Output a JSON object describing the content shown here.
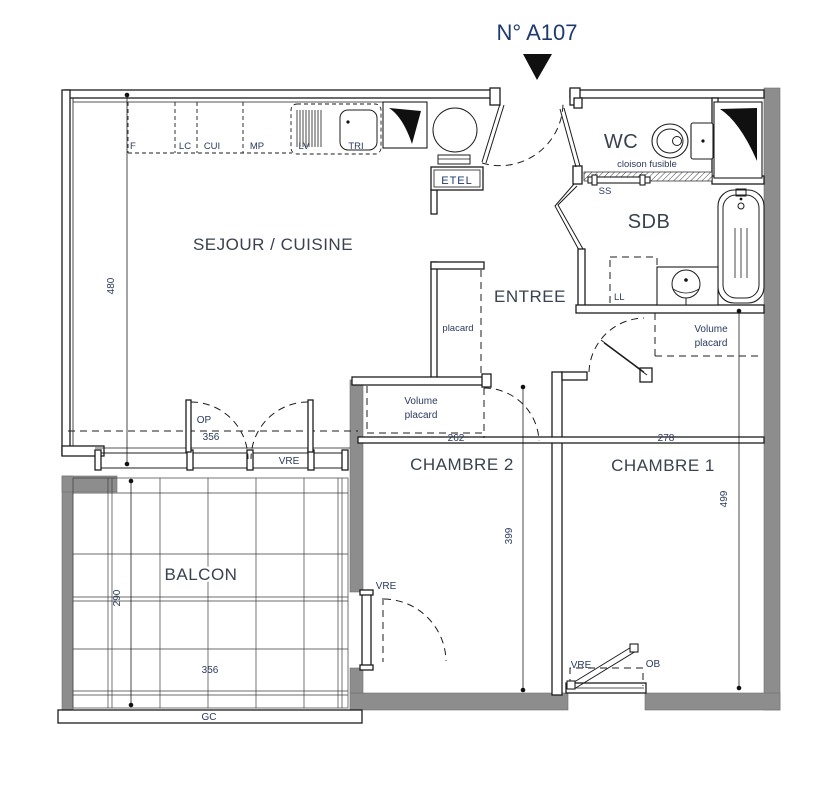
{
  "title": "N° A107",
  "rooms": {
    "sejour": "SEJOUR / CUISINE",
    "wc": "WC",
    "sdb": "SDB",
    "entree": "ENTREE",
    "chambre2": "CHAMBRE 2",
    "chambre1": "CHAMBRE 1",
    "balcon": "BALCON"
  },
  "kitchen": {
    "units": [
      "F",
      "LC",
      "CUI",
      "MP",
      "LV",
      "TRI"
    ],
    "etel": "ETEL"
  },
  "labels": {
    "cloison_fusible": "cloison fusible",
    "ss": "SS",
    "ll": "LL",
    "placard": "placard",
    "volume": "Volume",
    "volume_placard": "placard",
    "op": "OP",
    "vre": "VRE",
    "ob": "OB",
    "gc": "GC"
  },
  "dimensions": {
    "sejour_height": "480",
    "sejour_door_width": "356",
    "chambre2_width": "262",
    "chambre1_width": "278",
    "chambre2_height": "399",
    "chambre1_height": "499",
    "balcon_height": "290",
    "balcon_width": "356"
  },
  "colors": {
    "title_blue": "#1f3a6e",
    "label_blue": "#2b3a5e",
    "room_text": "#39424e",
    "wall_gray": "#8d8d8d",
    "line": "#1c1c1c"
  }
}
